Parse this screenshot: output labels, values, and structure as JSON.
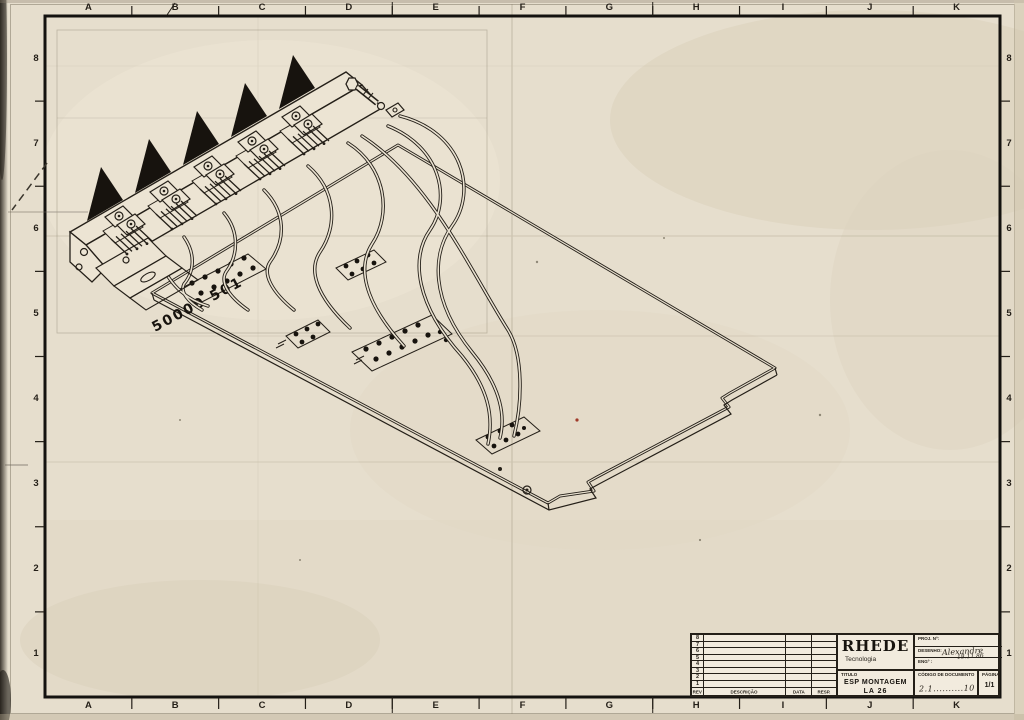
{
  "margin": {
    "columns": [
      "A",
      "B",
      "C",
      "D",
      "E",
      "F",
      "G",
      "H",
      "I",
      "J",
      "K"
    ],
    "rows": [
      "8",
      "7",
      "6",
      "5",
      "4",
      "3",
      "2",
      "1"
    ]
  },
  "drawing": {
    "board_label": "50000 501"
  },
  "title_block": {
    "revision_table": {
      "rows": [
        "8",
        "7",
        "6",
        "5",
        "4",
        "3",
        "2",
        "1"
      ],
      "headers": {
        "rev": "REV",
        "descricao": "DESCRIÇÃO",
        "data": "DATA",
        "resp": "RESP."
      }
    },
    "company": {
      "name": "RHEDE",
      "tagline": "Tecnologia"
    },
    "fields": {
      "proj_label": "PROJ. Nº:",
      "desenho_label": "DESENHO:",
      "desenho_value": "Alexandre",
      "desenho_date": "18.11.86",
      "eng_label": "ENGº :"
    },
    "titulo": {
      "label": "TITULO",
      "line1": "ESP MONTAGEM",
      "line2": "LA 26"
    },
    "codigo": {
      "label": "CÓDIGO DE DOCUMENTO",
      "value": "2.1..........10"
    },
    "pagina": {
      "label": "PÁGINA",
      "value": "1/1"
    }
  },
  "colors": {
    "paper": "#e6decd",
    "ink": "#241f18",
    "speck_red": "#a03b2a"
  }
}
